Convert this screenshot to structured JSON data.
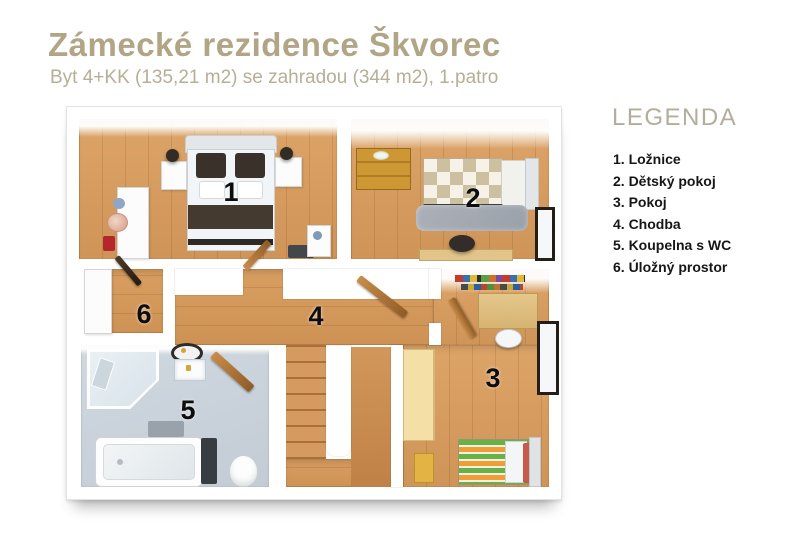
{
  "header": {
    "title": "Zámecké rezidence Škvorec",
    "subtitle": "Byt 4+KK (135,21 m2) se zahradou (344 m2), 1.patro"
  },
  "legend": {
    "heading": "LEGENDA",
    "items": [
      {
        "label": "1. Ložnice"
      },
      {
        "label": "2. Dětský pokoj"
      },
      {
        "label": "3. Pokoj"
      },
      {
        "label": "4. Chodba"
      },
      {
        "label": "5. Koupelna s WC"
      },
      {
        "label": "6. Úložný prostor"
      }
    ]
  },
  "plan": {
    "room_numbers": {
      "r1": "1",
      "r2": "2",
      "r3": "3",
      "r4": "4",
      "r5": "5",
      "r6": "6"
    }
  },
  "colors": {
    "title_text": "#b1a586",
    "subtitle_text": "#b7ae96",
    "legend_heading": "#b5ad9c",
    "legend_text": "#161616",
    "wood_floor": "#d59a5f",
    "bathroom_floor": "#c9d2db",
    "wall": "#ffffff",
    "room_number_text": "#0d0d0d"
  }
}
